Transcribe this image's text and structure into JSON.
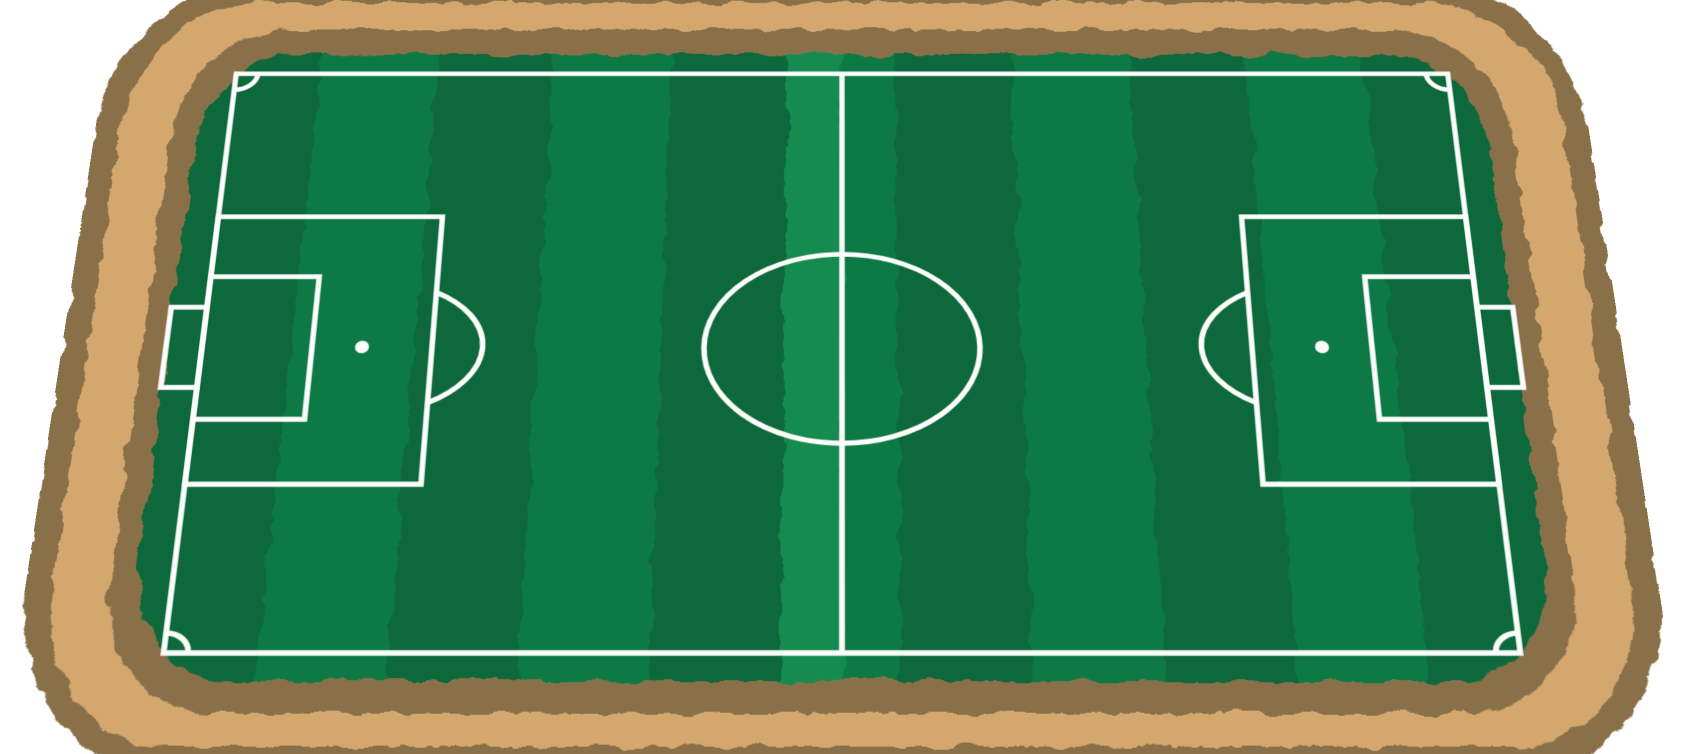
{
  "scene": {
    "title": "Illustrated top-down soccer field with dirt border",
    "view": "perspective, top edge receding"
  },
  "colors": {
    "page_background": "#ffffff",
    "dirt_brown": "#8a7049",
    "dirt_tan": "#d3a76e",
    "grass_dark": "#0e693a",
    "grass_light": "#117a44",
    "grass_highlight": "#178b4f",
    "line_white": "#fdfdfc"
  },
  "field": {
    "stripe_area": {
      "x": 106,
      "y": 92,
      "width": 1348,
      "height": 700
    },
    "stripes": [
      {
        "x": 106,
        "w": 123,
        "color": "grass_dark"
      },
      {
        "x": 229,
        "w": 123,
        "color": "grass_light"
      },
      {
        "x": 352,
        "w": 123,
        "color": "grass_dark"
      },
      {
        "x": 475,
        "w": 124,
        "color": "grass_light"
      },
      {
        "x": 599,
        "w": 123,
        "color": "grass_dark"
      },
      {
        "x": 722,
        "w": 58,
        "color": "grass_highlight"
      },
      {
        "x": 780,
        "w": 56,
        "color": "grass_light"
      },
      {
        "x": 836,
        "w": 124,
        "color": "grass_dark"
      },
      {
        "x": 960,
        "w": 124,
        "color": "grass_light"
      },
      {
        "x": 1084,
        "w": 124,
        "color": "grass_dark"
      },
      {
        "x": 1208,
        "w": 123,
        "color": "grass_light"
      },
      {
        "x": 1331,
        "w": 123,
        "color": "grass_dark"
      }
    ],
    "markings": {
      "boundary": "touchlines and goal lines",
      "halfway_line": "vertical center line",
      "center_circle": "ellipse at midfield",
      "penalty_areas": 2,
      "goal_areas": 2,
      "goals": 2,
      "penalty_spots": 2,
      "penalty_arcs": 2,
      "corner_arcs": 4
    }
  }
}
